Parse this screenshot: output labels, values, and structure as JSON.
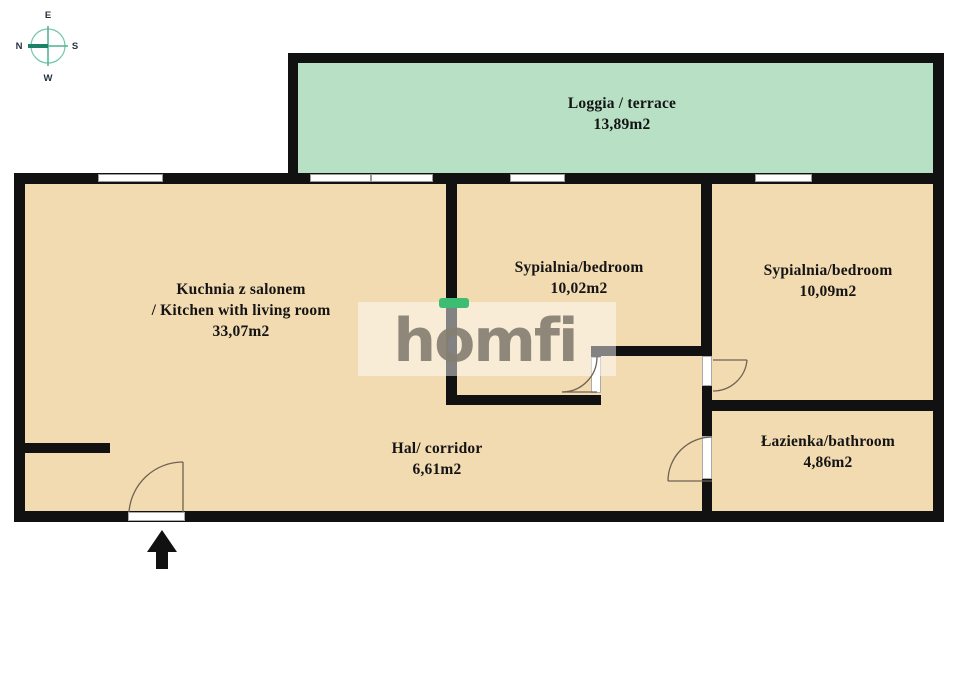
{
  "title": "Apartment floor plan",
  "compass": {
    "top": "E",
    "right": "S",
    "bottom": "W",
    "left": "N"
  },
  "rooms": [
    {
      "id": "loggia",
      "name": "Loggia / terrace",
      "area": "13,89m2"
    },
    {
      "id": "kitchen",
      "name": "Kuchnia z salonem",
      "name2": "/ Kitchen with living room",
      "area": "33,07m2"
    },
    {
      "id": "bedroom1",
      "name": "Sypialnia/bedroom",
      "area": "10,02m2"
    },
    {
      "id": "bedroom2",
      "name": "Sypialnia/bedroom",
      "area": "10,09m2"
    },
    {
      "id": "corridor",
      "name": "Hal/ corridor",
      "area": "6,61m2"
    },
    {
      "id": "bathroom",
      "name": "Łazienka/bathroom",
      "area": "4,86m2"
    }
  ],
  "watermark": {
    "part1": "h",
    "part2": "o",
    "part3": "mfi"
  },
  "colors": {
    "floor": "#f2dbb1",
    "loggia_floor": "#b7e0c5",
    "wall": "#111111",
    "brand_green": "#3dbd72",
    "logo_gray": "#867e72",
    "compass_teal": "#3aa98c"
  }
}
